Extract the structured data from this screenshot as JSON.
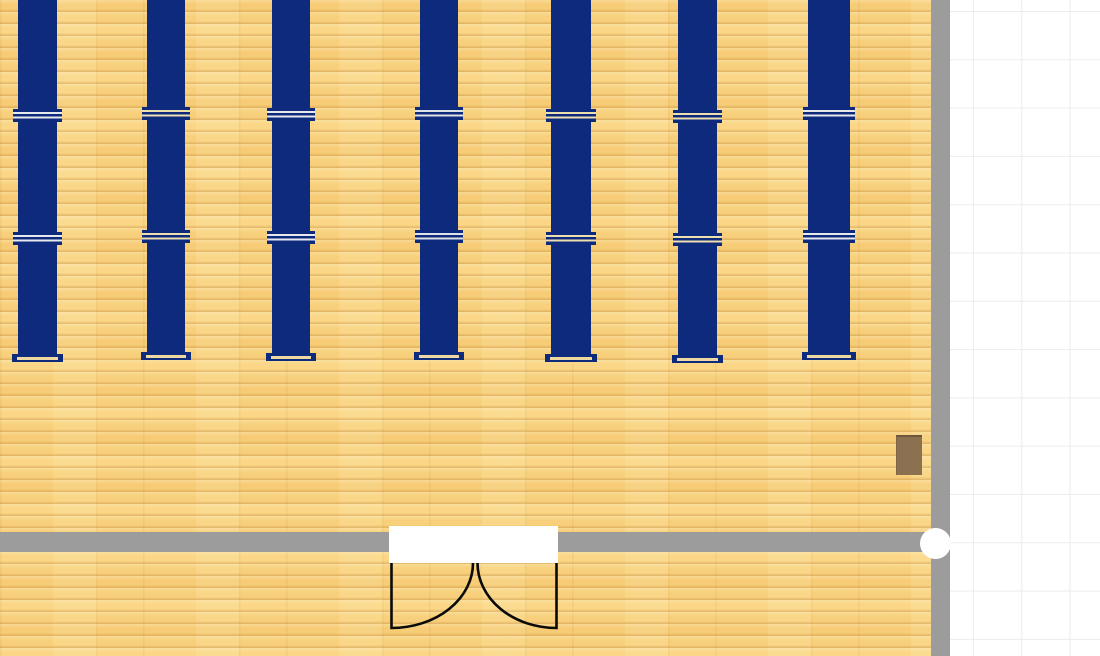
{
  "colors": {
    "background": "#ffffff",
    "floor_base": "#f8d07c",
    "wall": "#9c9c9c",
    "grid_line": "#ececec",
    "table_navy": "#0e2a7c",
    "bench_stripe": "#efd9a2",
    "cabinet_brown": "#8b7150",
    "door_line": "#0a0a0a",
    "door_opening": "#ffffff",
    "handle": "#ffffff"
  },
  "grid": {
    "size": 48.3,
    "offset_x": 7,
    "offset_y": 11
  },
  "floor": {
    "x": 0,
    "y": 0,
    "w": 931,
    "h": 656
  },
  "walls": {
    "right": {
      "x": 931,
      "y": 0,
      "w": 18.5,
      "h": 656
    },
    "bottom": {
      "x": 0,
      "y": 532,
      "w": 949,
      "h": 20
    }
  },
  "door": {
    "x": 380,
    "y": 520,
    "w": 200,
    "h": 115,
    "opening": {
      "x": 9,
      "y": 6,
      "w": 169,
      "h": 37
    },
    "left_leaf_path": "M 11.5 43 L 11.5 108 A 81.5 65 0 0 0 93 43",
    "right_leaf_path": "M 176.5 43 L 176.5 108 A 79 65 0 0 1 97.5 43",
    "stroke_width": 2.6
  },
  "cabinet": {
    "x": 896,
    "y": 435,
    "w": 26,
    "h": 40
  },
  "wall_handle": {
    "cx": 935,
    "cy": 543,
    "r": 15.5
  },
  "furniture": {
    "layout": {
      "body_top": -6,
      "body_bottom": 352,
      "bar1_y": 107,
      "bar2_y": 230,
      "bar_h": 13,
      "bar_overhang": 5,
      "bench_h": 8,
      "bench_overhang": 6
    },
    "columns": [
      {
        "x": 18,
        "w": 39,
        "dy": 2,
        "stripe": "#e7e9ed"
      },
      {
        "x": 147,
        "w": 38,
        "dy": 0,
        "stripe": "#eddfae"
      },
      {
        "x": 272,
        "w": 38,
        "dy": 1,
        "stripe": "#e7e9ed"
      },
      {
        "x": 420,
        "w": 38,
        "dy": 0,
        "stripe": "#dfe2e6"
      },
      {
        "x": 551,
        "w": 40,
        "dy": 2,
        "stripe": "#eddfae"
      },
      {
        "x": 678,
        "w": 39,
        "dy": 3,
        "stripe": "#eddfae"
      },
      {
        "x": 808,
        "w": 42,
        "dy": 0,
        "stripe": "#e7e9ed"
      }
    ]
  }
}
